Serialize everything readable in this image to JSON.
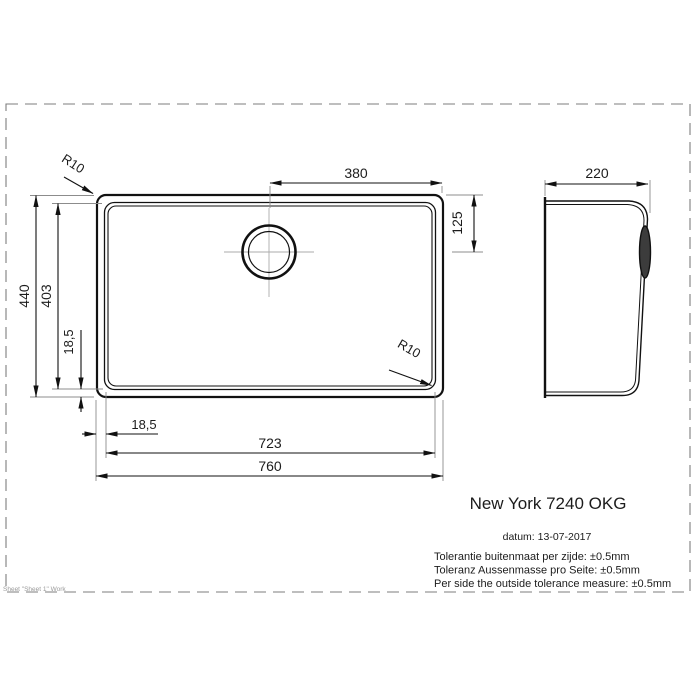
{
  "page": {
    "background": "#ffffff",
    "border_color": "#7d7d7d",
    "line_color": "#111111"
  },
  "drawing": {
    "product_title": "New York 7240 OKG",
    "date_line": "datum: 13-07-2017",
    "tolerance_lines": [
      "Tolerantie buitenmaat per zijde: ±0.5mm",
      "Toleranz Aussenmasse pro Seite: ±0.5mm",
      "Per side the outside tolerance measure: ±0.5mm"
    ],
    "sheet_footer": "Sheet \"Sheet 1\" Work",
    "top_view": {
      "dim_drain_to_right_edge": "380",
      "dim_drain_from_top": "125",
      "dim_outer_height": "440",
      "dim_inner_height": "403",
      "dim_rim_offset_vertical": "18,5",
      "dim_rim_offset_horizontal": "18,5",
      "dim_inner_width": "723",
      "dim_outer_width": "760",
      "radius_top_left": "R10",
      "radius_bottom_right": "R10"
    },
    "side_view": {
      "dim_depth": "220"
    }
  }
}
